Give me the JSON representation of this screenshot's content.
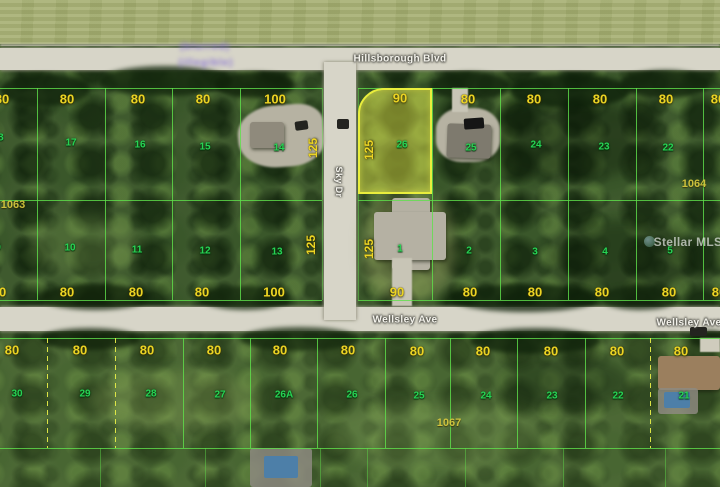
{
  "map_type": "aerial-parcel-map",
  "streets": {
    "top": "Hillsborough Blvd",
    "bottom": "Wellsley Ave",
    "cross_vertical": "Sky Dr"
  },
  "highlight": {
    "lot_number": "26",
    "frontage_ft": "90",
    "depth_ft": "125",
    "outline_color": "#e9ee3d",
    "fill_color": "rgba(233,234,72,0.46)"
  },
  "block_numbers": [
    "1063",
    "1064",
    "1067"
  ],
  "watermarks": {
    "mls": "Stellar MLS",
    "top_left": "illegible purple text"
  },
  "colors": {
    "dimension_text": "#ecd424",
    "lot_text": "#27d354",
    "line_green": "rgba(95,225,75,0.8)",
    "road": "#d7d5c8"
  },
  "labels": [
    {
      "c": "d",
      "t": "80",
      "x": 2,
      "y": 99
    },
    {
      "c": "d",
      "t": "80",
      "x": 67,
      "y": 99
    },
    {
      "c": "d",
      "t": "80",
      "x": 138,
      "y": 99
    },
    {
      "c": "d",
      "t": "80",
      "x": 203,
      "y": 99
    },
    {
      "c": "d",
      "t": "100",
      "x": 275,
      "y": 99
    },
    {
      "c": "d",
      "t": "90",
      "x": 400,
      "y": 98
    },
    {
      "c": "d",
      "t": "80",
      "x": 468,
      "y": 99
    },
    {
      "c": "d",
      "t": "80",
      "x": 534,
      "y": 99
    },
    {
      "c": "d",
      "t": "80",
      "x": 600,
      "y": 99
    },
    {
      "c": "d",
      "t": "80",
      "x": 666,
      "y": 99
    },
    {
      "c": "d",
      "t": "80",
      "x": 718,
      "y": 99
    },
    {
      "c": "d",
      "t": "80",
      "x": -1,
      "y": 292
    },
    {
      "c": "d",
      "t": "80",
      "x": 67,
      "y": 292
    },
    {
      "c": "d",
      "t": "80",
      "x": 136,
      "y": 292
    },
    {
      "c": "d",
      "t": "80",
      "x": 202,
      "y": 292
    },
    {
      "c": "d",
      "t": "100",
      "x": 274,
      "y": 292
    },
    {
      "c": "d",
      "t": "90",
      "x": 397,
      "y": 292
    },
    {
      "c": "d",
      "t": "80",
      "x": 470,
      "y": 292
    },
    {
      "c": "d",
      "t": "80",
      "x": 535,
      "y": 292
    },
    {
      "c": "d",
      "t": "80",
      "x": 602,
      "y": 292
    },
    {
      "c": "d",
      "t": "80",
      "x": 669,
      "y": 292
    },
    {
      "c": "d",
      "t": "80",
      "x": 719,
      "y": 292
    },
    {
      "c": "d",
      "t": "80",
      "x": 12,
      "y": 350
    },
    {
      "c": "d",
      "t": "80",
      "x": 80,
      "y": 350
    },
    {
      "c": "d",
      "t": "80",
      "x": 147,
      "y": 350
    },
    {
      "c": "d",
      "t": "80",
      "x": 214,
      "y": 350
    },
    {
      "c": "d",
      "t": "80",
      "x": 280,
      "y": 350
    },
    {
      "c": "d",
      "t": "80",
      "x": 348,
      "y": 350
    },
    {
      "c": "d",
      "t": "80",
      "x": 417,
      "y": 351
    },
    {
      "c": "d",
      "t": "80",
      "x": 483,
      "y": 351
    },
    {
      "c": "d",
      "t": "80",
      "x": 551,
      "y": 351
    },
    {
      "c": "d",
      "t": "80",
      "x": 617,
      "y": 351
    },
    {
      "c": "d",
      "t": "80",
      "x": 681,
      "y": 351
    },
    {
      "c": "dv",
      "t": "125",
      "x": 313,
      "y": 148
    },
    {
      "c": "dv",
      "t": "125",
      "x": 311,
      "y": 245
    },
    {
      "c": "dv",
      "t": "125",
      "x": 369,
      "y": 150
    },
    {
      "c": "dv",
      "t": "125",
      "x": 369,
      "y": 249
    },
    {
      "c": "l",
      "t": "18",
      "x": -2,
      "y": 138
    },
    {
      "c": "l",
      "t": "17",
      "x": 71,
      "y": 143
    },
    {
      "c": "l",
      "t": "16",
      "x": 140,
      "y": 145
    },
    {
      "c": "l",
      "t": "15",
      "x": 205,
      "y": 147
    },
    {
      "c": "l",
      "t": "14",
      "x": 279,
      "y": 148
    },
    {
      "c": "l",
      "t": "26",
      "x": 402,
      "y": 145
    },
    {
      "c": "l",
      "t": "25",
      "x": 471,
      "y": 148
    },
    {
      "c": "l",
      "t": "24",
      "x": 536,
      "y": 145
    },
    {
      "c": "l",
      "t": "23",
      "x": 604,
      "y": 147
    },
    {
      "c": "l",
      "t": "22",
      "x": 668,
      "y": 148
    },
    {
      "c": "l",
      "t": "9",
      "x": -2,
      "y": 248
    },
    {
      "c": "l",
      "t": "10",
      "x": 70,
      "y": 248
    },
    {
      "c": "l",
      "t": "11",
      "x": 137,
      "y": 250
    },
    {
      "c": "l",
      "t": "12",
      "x": 205,
      "y": 251
    },
    {
      "c": "l",
      "t": "13",
      "x": 277,
      "y": 252
    },
    {
      "c": "l",
      "t": "1",
      "x": 400,
      "y": 249
    },
    {
      "c": "l",
      "t": "2",
      "x": 469,
      "y": 251
    },
    {
      "c": "l",
      "t": "3",
      "x": 535,
      "y": 252
    },
    {
      "c": "l",
      "t": "4",
      "x": 605,
      "y": 252
    },
    {
      "c": "l",
      "t": "5",
      "x": 670,
      "y": 251
    },
    {
      "c": "l",
      "t": "30",
      "x": 17,
      "y": 394
    },
    {
      "c": "l",
      "t": "29",
      "x": 85,
      "y": 394
    },
    {
      "c": "l",
      "t": "28",
      "x": 151,
      "y": 394
    },
    {
      "c": "l",
      "t": "27",
      "x": 220,
      "y": 395
    },
    {
      "c": "l",
      "t": "26A",
      "x": 284,
      "y": 395
    },
    {
      "c": "l",
      "t": "26",
      "x": 352,
      "y": 395
    },
    {
      "c": "l",
      "t": "25",
      "x": 419,
      "y": 396
    },
    {
      "c": "l",
      "t": "24",
      "x": 486,
      "y": 396
    },
    {
      "c": "l",
      "t": "23",
      "x": 552,
      "y": 396
    },
    {
      "c": "l",
      "t": "22",
      "x": 618,
      "y": 396
    },
    {
      "c": "l",
      "t": "21",
      "x": 684,
      "y": 396
    },
    {
      "c": "b",
      "t": "1063",
      "x": 13,
      "y": 205
    },
    {
      "c": "b",
      "t": "1064",
      "x": 694,
      "y": 184
    },
    {
      "c": "b",
      "t": "1067",
      "x": 449,
      "y": 423
    },
    {
      "c": "s",
      "t": "Hillsborough Blvd",
      "x": 400,
      "y": 59,
      "n": "street-label-hillsborough-blvd"
    },
    {
      "c": "s",
      "t": "Wellsley Ave",
      "x": 405,
      "y": 320,
      "n": "street-label-wellsley-ave"
    },
    {
      "c": "s",
      "t": "Wellsley Ave",
      "x": 689,
      "y": 323,
      "n": "street-label-wellsley-ave-east"
    },
    {
      "c": "sv",
      "t": "Sky Dr",
      "x": 339,
      "y": 182,
      "n": "street-label-cross-vertical"
    },
    {
      "c": "m",
      "t": "Stellar MLS",
      "x": 688,
      "y": 242,
      "n": "stellar-mls-watermark"
    },
    {
      "c": "w",
      "t": "(blurred)",
      "x": 205,
      "y": 47,
      "n": "purple-watermark-line-1"
    },
    {
      "c": "w",
      "t": "(illegible)",
      "x": 206,
      "y": 63,
      "n": "purple-watermark-line-2"
    }
  ]
}
